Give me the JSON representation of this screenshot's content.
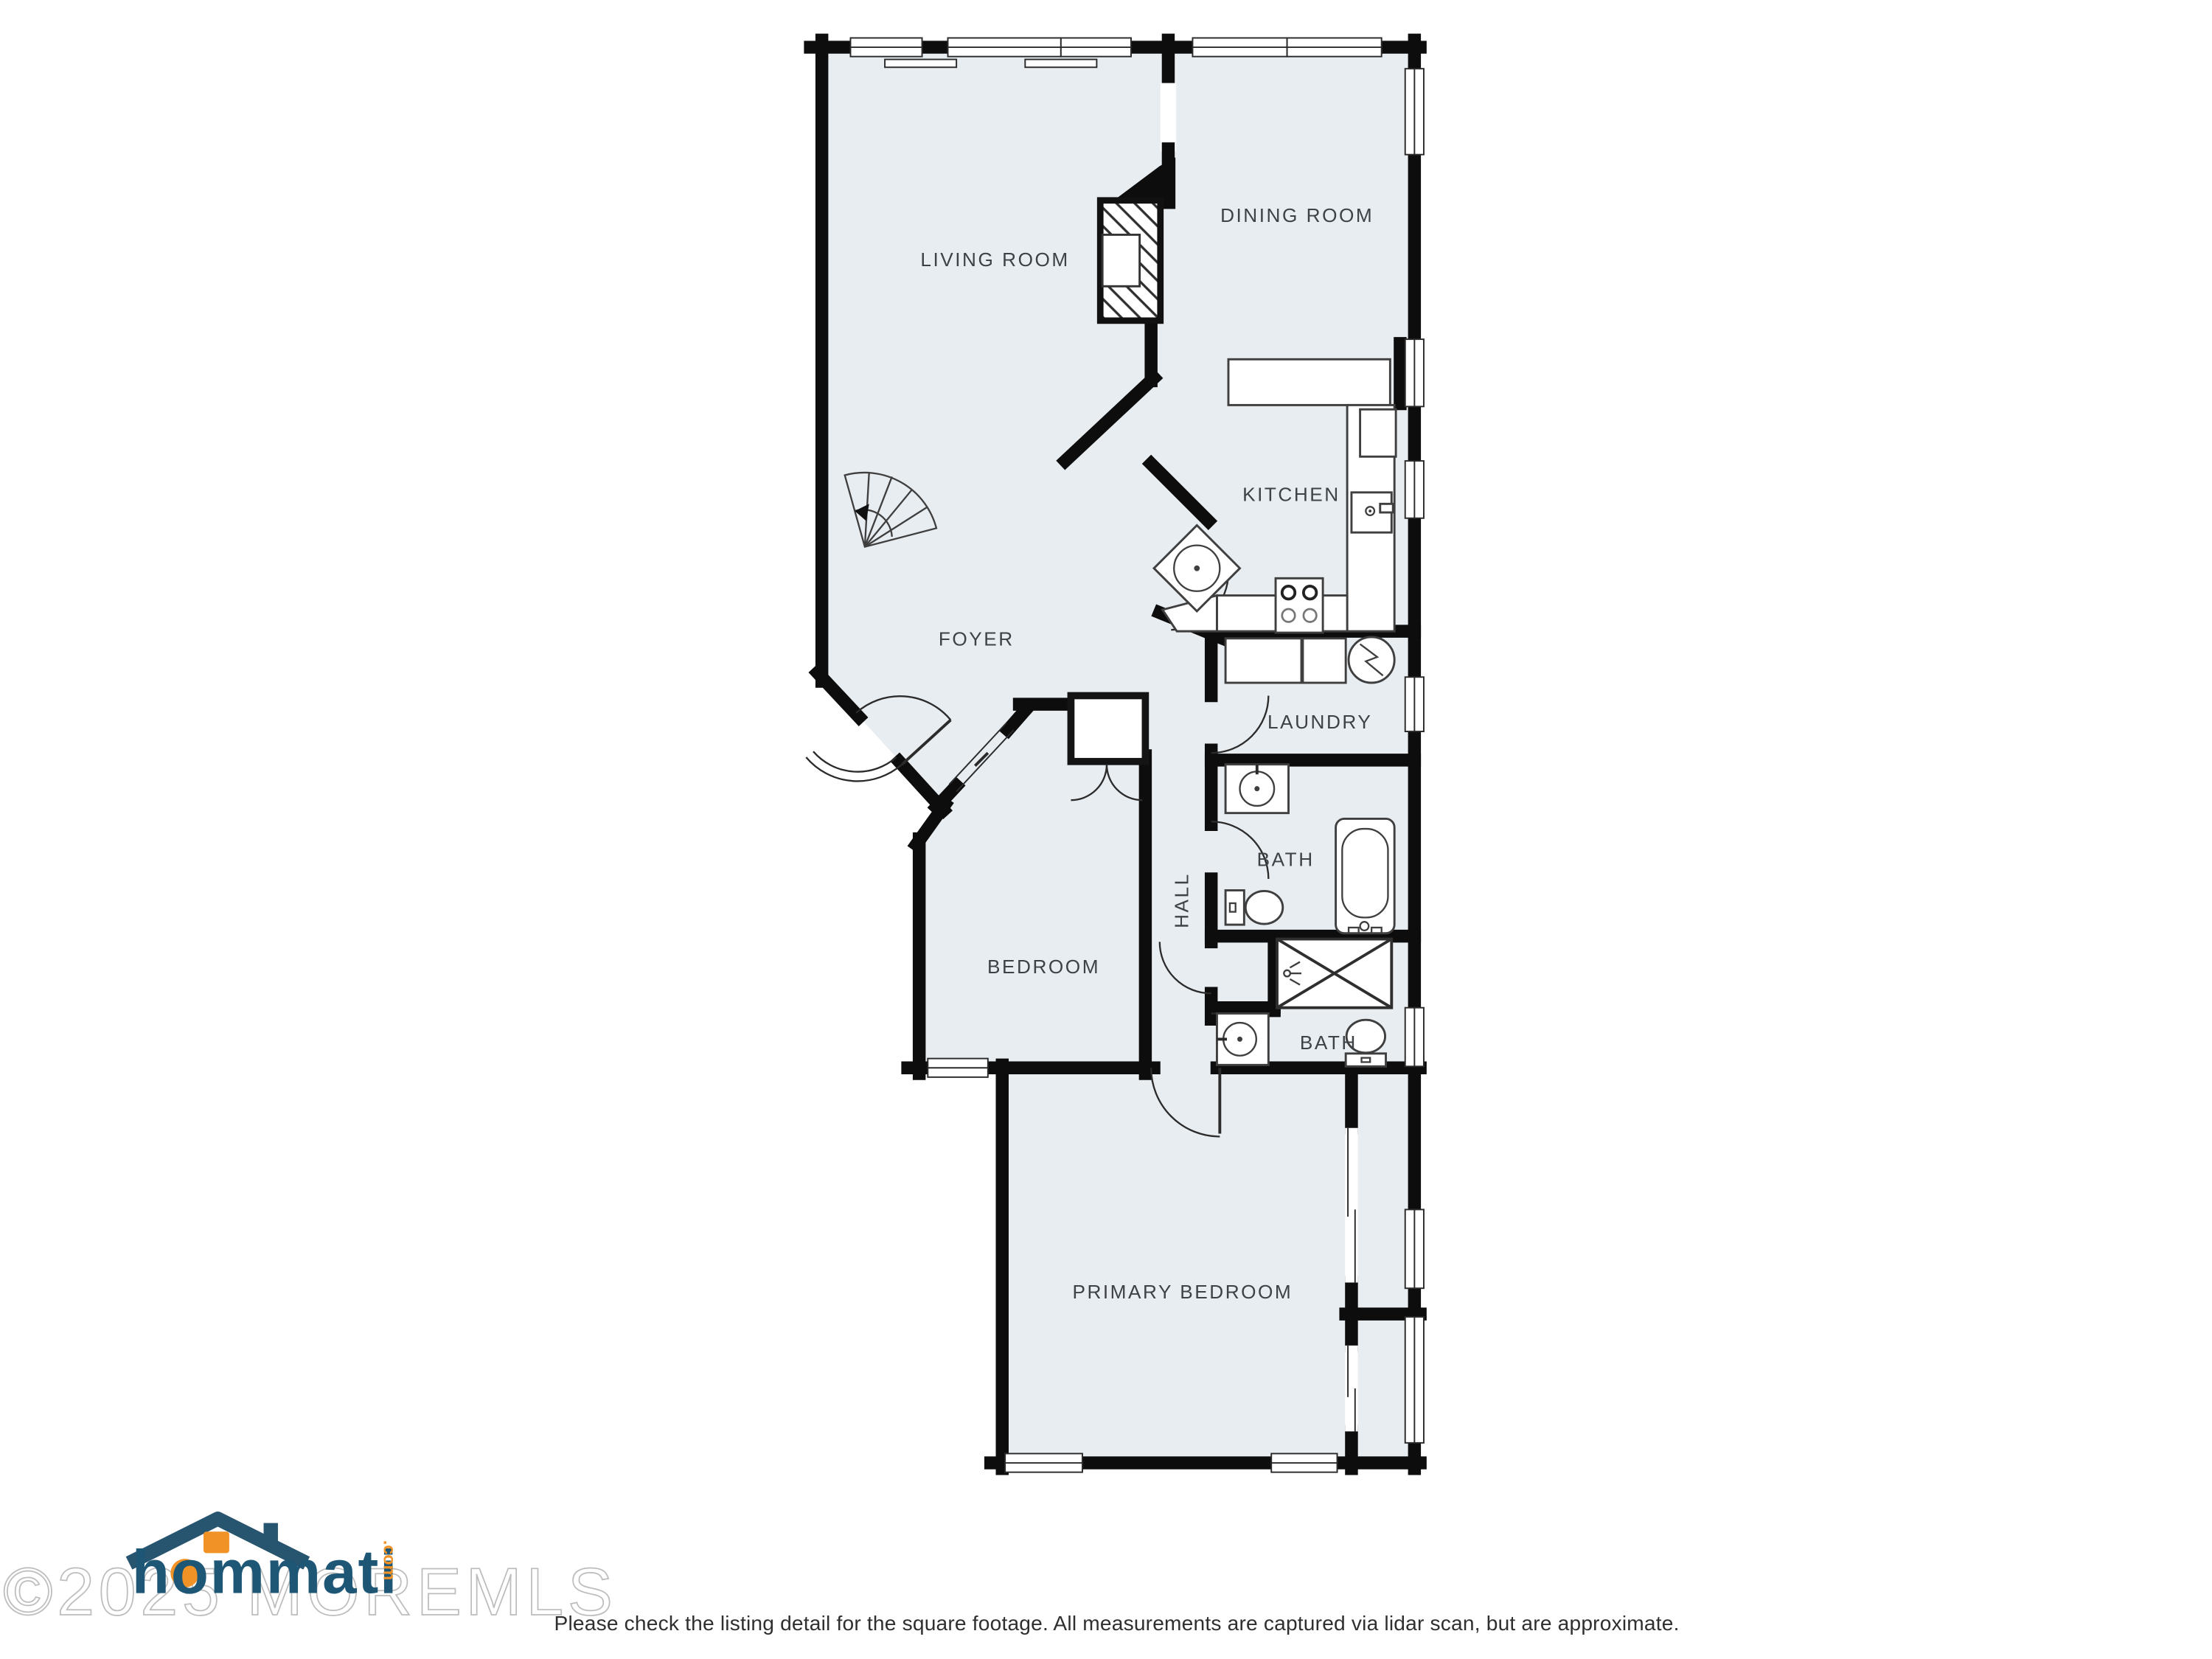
{
  "rooms": {
    "living": {
      "label": "LIVING ROOM"
    },
    "dining": {
      "label": "DINING ROOM"
    },
    "kitchen": {
      "label": "KITCHEN"
    },
    "foyer": {
      "label": "FOYER"
    },
    "laundry": {
      "label": "LAUNDRY"
    },
    "bath1": {
      "label": "BATH"
    },
    "hall": {
      "label": "HALL"
    },
    "bedroom": {
      "label": "BEDROOM"
    },
    "bath2": {
      "label": "BATH"
    },
    "primary": {
      "label": "PRIMARY BEDROOM"
    }
  },
  "watermark": {
    "copyright": "©2025 MOREMLS",
    "logo_text": "hommati",
    "logo_suffix": ".com"
  },
  "footer": {
    "disclaimer": "Please check the listing detail for the square footage. All measurements are captured via lidar scan, but are approximate."
  },
  "icons": [
    "fireplace",
    "winder-stairs",
    "front-door",
    "sliding-door",
    "closet-double-doors",
    "corner-sink",
    "kitchen-sink",
    "stove",
    "refrigerator",
    "washer",
    "dryer",
    "water-heater",
    "vanity-sink",
    "toilet",
    "bathtub",
    "shower",
    "linen-closet",
    "sliding-closet-doors"
  ],
  "colors": {
    "floor": "#e8edf1",
    "wall": "#0d0d0d",
    "label": "#3d4246",
    "watermark": "#bdbdbd",
    "logo_blue": "#1e5676",
    "logo_orange": "#f09226"
  }
}
